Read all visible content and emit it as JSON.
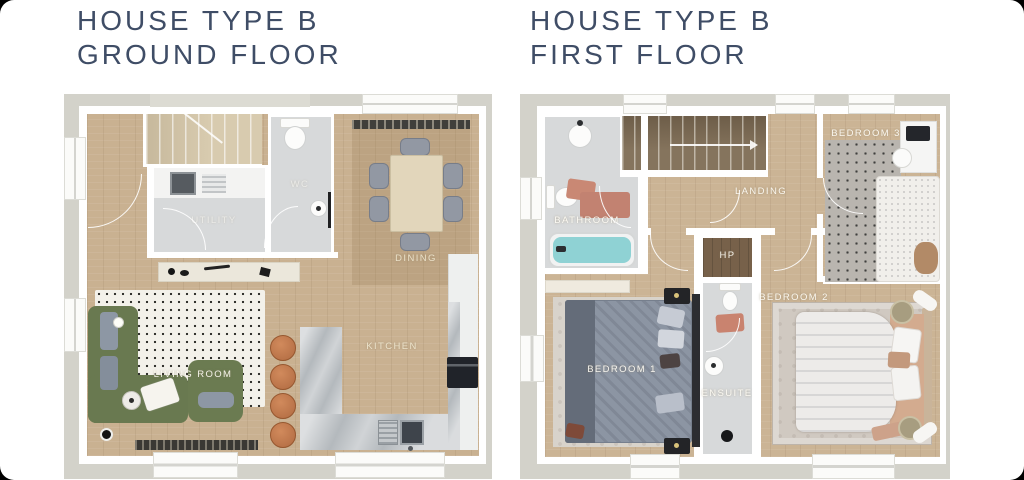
{
  "panels": {
    "ground": {
      "title_line1": "HOUSE TYPE B",
      "title_line2": "GROUND FLOOR",
      "rooms": {
        "utility": "UTILITY",
        "wc": "WC",
        "dining": "DINING",
        "living": "LIVING ROOM",
        "kitchen": "KITCHEN"
      }
    },
    "first": {
      "title_line1": "HOUSE TYPE B",
      "title_line2": "FIRST FLOOR",
      "rooms": {
        "bathroom": "BATHROOM",
        "landing": "LANDING",
        "hp": "HP",
        "bedroom3": "BEDROOM 3",
        "bedroom2": "BEDROOM 2",
        "bedroom1": "BEDROOM 1",
        "ensuite": "ENSUITE"
      }
    }
  },
  "colors": {
    "title_text": "#3f4d66",
    "exterior_band": "#d3d2ca",
    "wall": "#ffffff",
    "wood_floor": "#c9b191",
    "tile_floor": "#d7d9da",
    "sofa_green": "#697950",
    "stool_orange": "#c57a4e",
    "counter_marble": "#b4b9bd",
    "bath_water": "#8fd2d4",
    "bed_gray": "#8c95a3",
    "mat_pink": "#c9836f"
  }
}
